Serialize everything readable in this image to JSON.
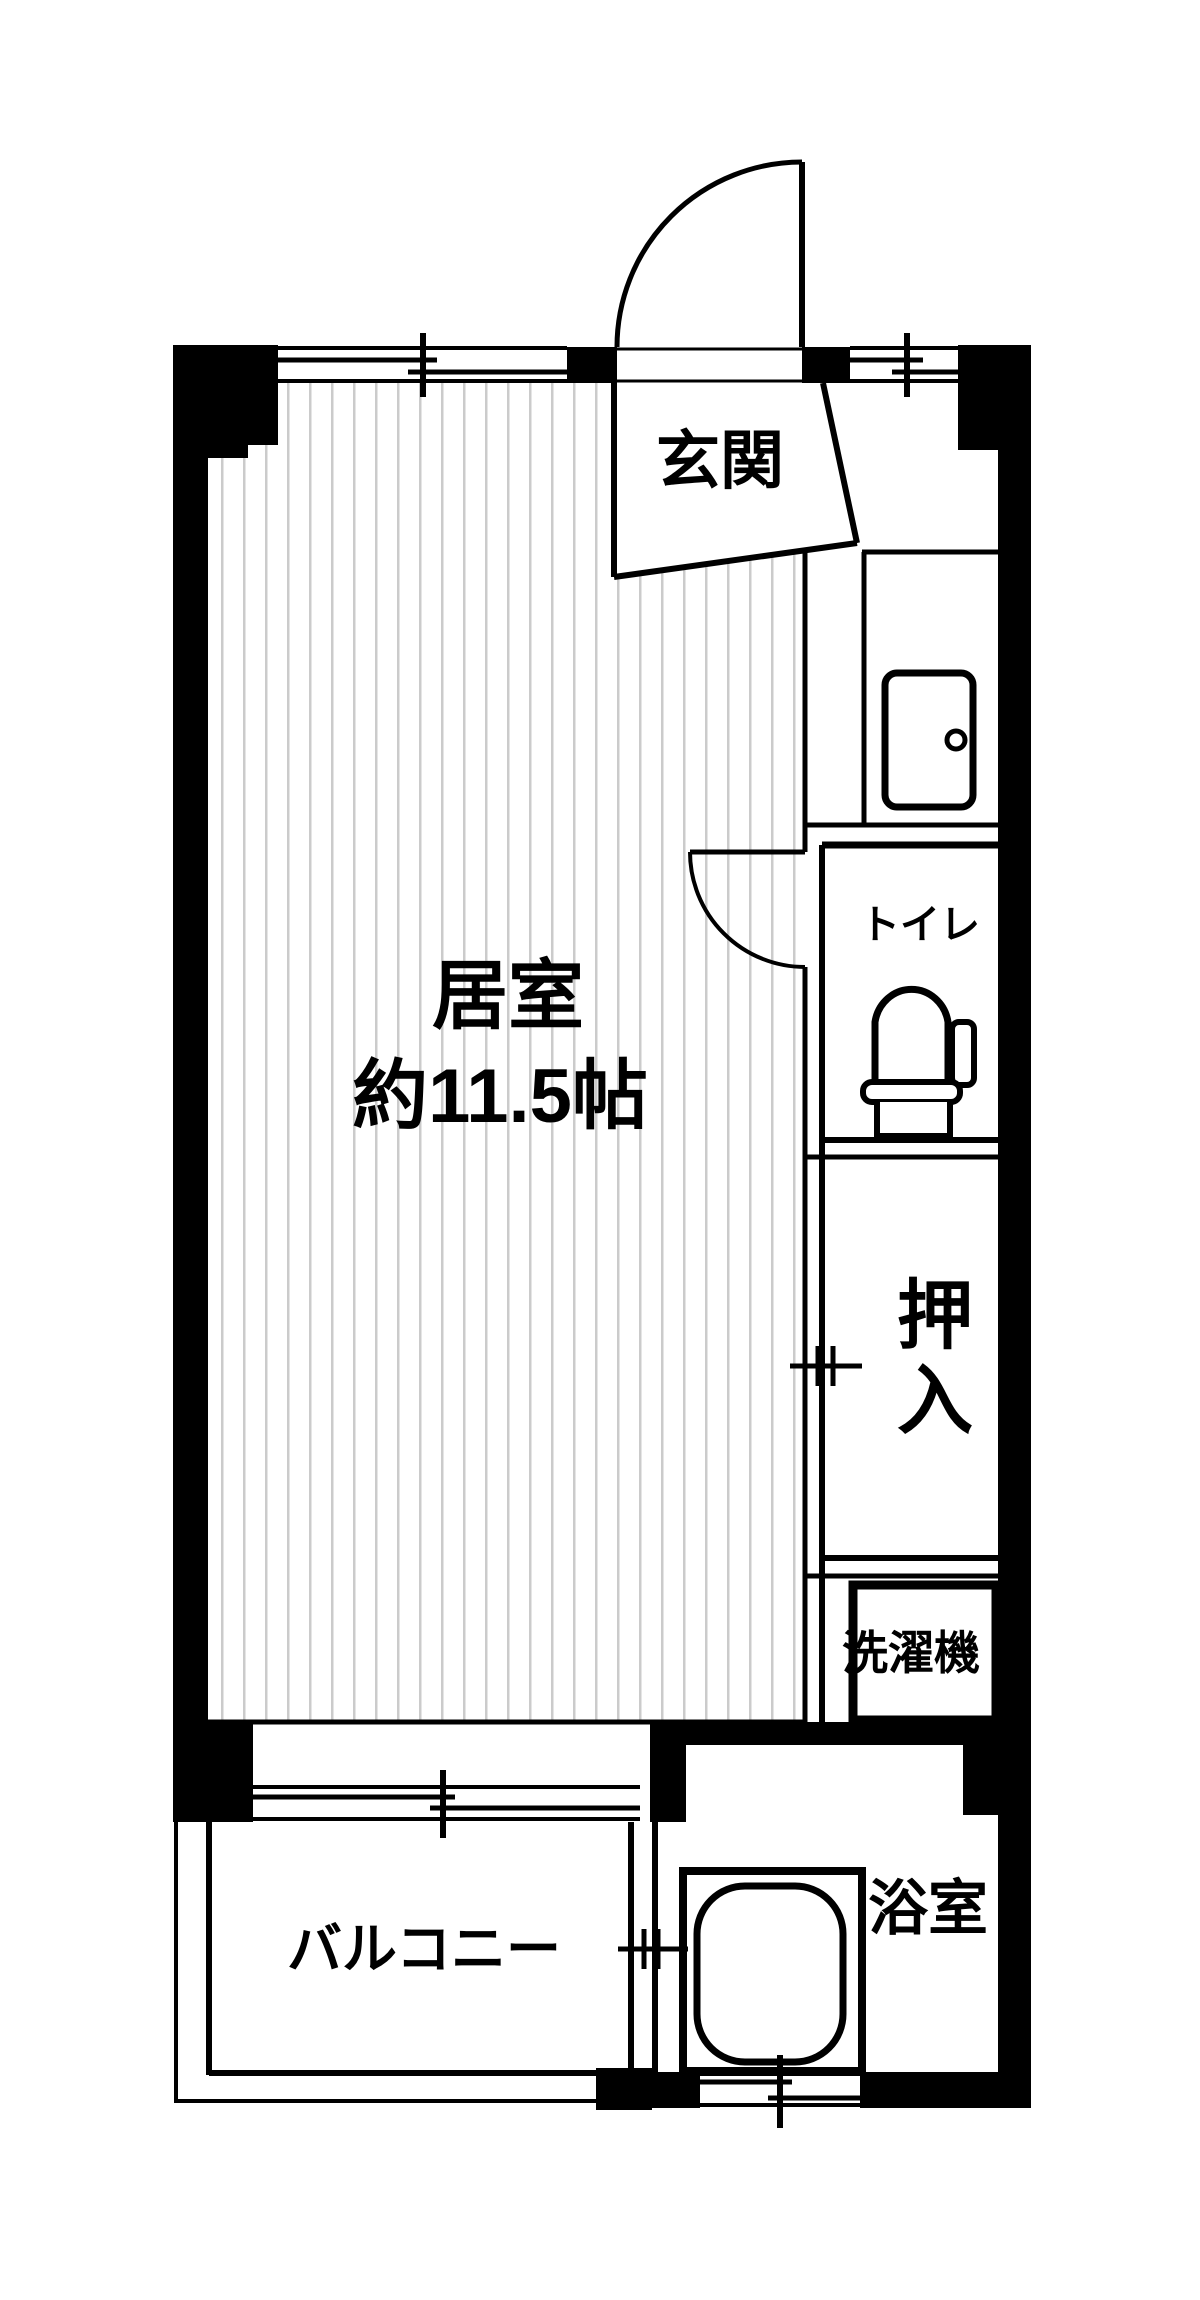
{
  "figure_type": "apartment-floor-plan",
  "colors": {
    "line": "#000000",
    "wall_fill": "#000000",
    "floor_hatch": "#cbcbcb",
    "background": "#ffffff"
  },
  "rooms": {
    "living": {
      "label": "居室",
      "size_label": "約11.5帖"
    },
    "entrance": {
      "label": "玄関"
    },
    "toilet": {
      "label": "トイレ"
    },
    "closet": {
      "label": "押入",
      "chars": [
        "押",
        "入"
      ]
    },
    "laundry": {
      "label": "洗濯機"
    },
    "balcony": {
      "label": "バルコニー"
    },
    "bathroom": {
      "label": "浴室"
    }
  },
  "icons": [
    "entrance-door-swing-icon",
    "interior-door-swing-icon",
    "shoe-cabinet-icon",
    "toilet-icon",
    "washer-pan-icon",
    "bathtub-icon",
    "window-icon",
    "dimension-tick-icon"
  ]
}
